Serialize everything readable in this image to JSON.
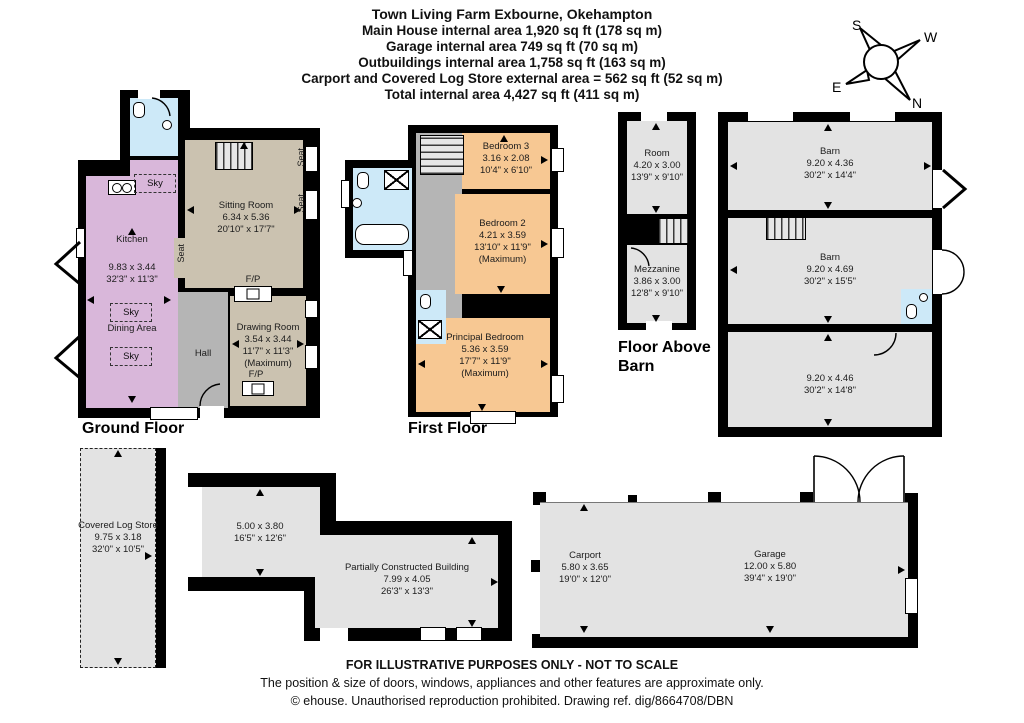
{
  "header": {
    "title": "Town Living Farm Exbourne, Okehampton",
    "line_main_house": "Main House internal area 1,920 sq ft (178 sq m)",
    "line_garage": "Garage internal area 749 sq ft (70 sq m)",
    "line_outbuildings": "Outbuildings internal area 1,758 sq ft (163 sq m)",
    "line_carport": "Carport and Covered Log Store external area = 562 sq ft (52 sq m)",
    "line_total": "Total internal area 4,427 sq ft (411 sq m)"
  },
  "compass": {
    "n": "N",
    "s": "S",
    "e": "E",
    "w": "W"
  },
  "labels": {
    "ground_floor": "Ground Floor",
    "first_floor": "First Floor",
    "floor_above_barn": "Floor Above Barn",
    "sky": "Sky",
    "seat": "Seat",
    "fireplace": "F/P"
  },
  "ground_floor": {
    "kitchen": {
      "name": "Kitchen",
      "metric": "9.83 x 3.44",
      "imperial": "32'3\" x 11'3\""
    },
    "dining_area": {
      "name": "Dining Area"
    },
    "sitting_room": {
      "name": "Sitting Room",
      "metric": "6.34 x 5.36",
      "imperial": "20'10\" x 17'7\""
    },
    "drawing_room": {
      "name": "Drawing Room",
      "metric": "3.54 x 3.44",
      "imperial": "11'7\" x 11'3\"",
      "note": "(Maximum)"
    },
    "hall": {
      "name": "Hall"
    }
  },
  "first_floor": {
    "bedroom_3": {
      "name": "Bedroom 3",
      "metric": "3.16 x 2.08",
      "imperial": "10'4\" x 6'10\""
    },
    "bedroom_2": {
      "name": "Bedroom 2",
      "metric": "4.21 x 3.59",
      "imperial": "13'10\" x 11'9\"",
      "note": "(Maximum)"
    },
    "principal_bedroom": {
      "name": "Principal Bedroom",
      "metric": "5.36 x 3.59",
      "imperial": "17'7\" x 11'9\"",
      "note": "(Maximum)"
    }
  },
  "floor_above_barn": {
    "room": {
      "name": "Room",
      "metric": "4.20 x 3.00",
      "imperial": "13'9\" x 9'10\""
    },
    "mezzanine": {
      "name": "Mezzanine",
      "metric": "3.86 x 3.00",
      "imperial": "12'8\" x 9'10\""
    }
  },
  "barn": {
    "barn_upper": {
      "name": "Barn",
      "metric": "9.20 x 4.36",
      "imperial": "30'2\" x 14'4\""
    },
    "barn_lower": {
      "name": "Barn",
      "metric": "9.20 x 4.69",
      "imperial": "30'2\" x 15'5\""
    },
    "barn_open": {
      "metric": "9.20 x 4.46",
      "imperial": "30'2\" x 14'8\""
    }
  },
  "outbuildings": {
    "covered_log_store": {
      "name": "Covered Log Store",
      "metric": "9.75 x 3.18",
      "imperial": "32'0\" x 10'5\""
    },
    "partial_left": {
      "metric": "5.00 x 3.80",
      "imperial": "16'5\" x 12'6\""
    },
    "partially_constructed": {
      "name": "Partially Constructed Building",
      "metric": "7.99 x 4.05",
      "imperial": "26'3\" x 13'3\""
    },
    "carport": {
      "name": "Carport",
      "metric": "5.80 x 3.65",
      "imperial": "19'0\" x 12'0\""
    },
    "garage": {
      "name": "Garage",
      "metric": "12.00 x 5.80",
      "imperial": "39'4\" x 19'0\""
    }
  },
  "footer": {
    "line1": "FOR ILLUSTRATIVE PURPOSES ONLY - NOT TO SCALE",
    "line2": "The position & size of doors, windows, appliances and other features are approximate only.",
    "line3": "© ehouse. Unauthorised reproduction prohibited. Drawing ref. dig/8664708/DBN"
  },
  "colors": {
    "wall": "#000000",
    "reception_room": "#cbc2b0",
    "kitchen": "#d9b7da",
    "hall": "#b5b5b5",
    "bathroom": "#cde9f8",
    "bedroom": "#f7c893",
    "outbuilding": "#e3e3e3"
  }
}
